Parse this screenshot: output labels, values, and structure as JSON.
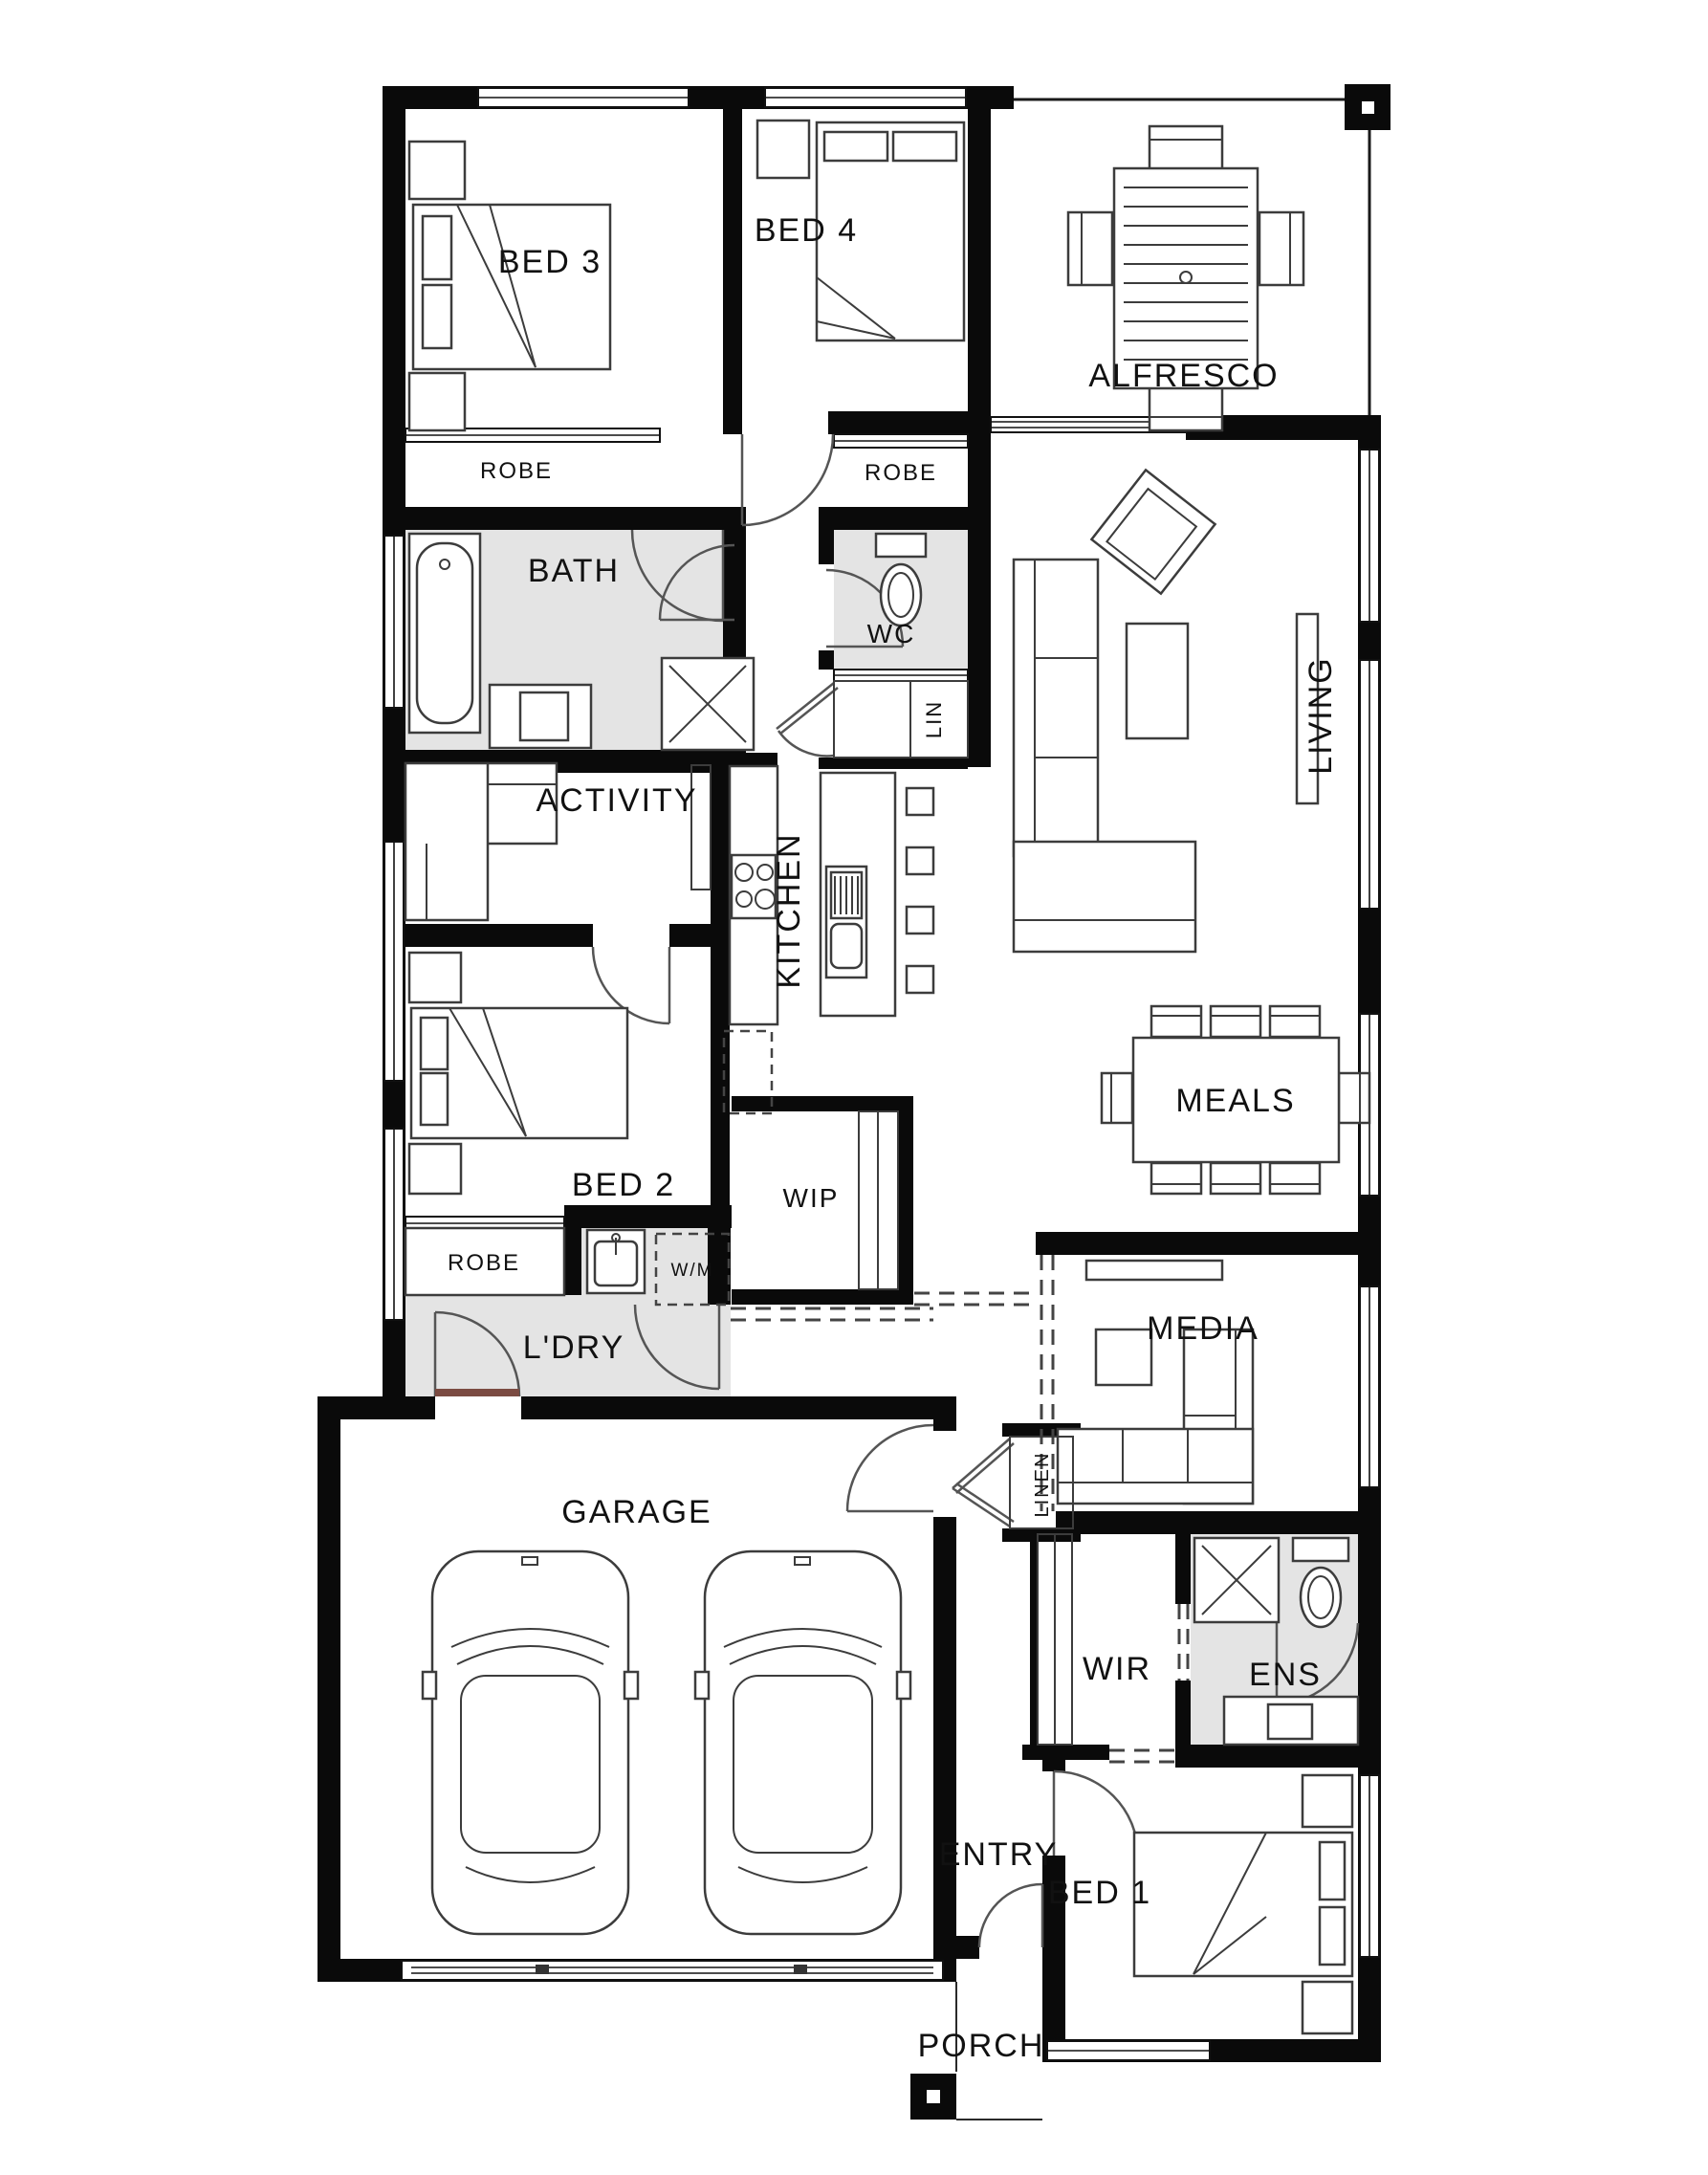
{
  "title": "Single storey home floor plan",
  "colors": {
    "background": "#ffffff",
    "walls": "#0a0a0a",
    "wet_area_fill": "#e4e4e4",
    "furniture_line": "#3c3c3c",
    "threshold": "#7b4b42"
  },
  "labels": {
    "bed3": "BED 3",
    "bed4": "BED 4",
    "alfresco": "ALFRESCO",
    "robe_bed3": "ROBE",
    "robe_bed4": "ROBE",
    "bath": "BATH",
    "wc": "WC",
    "lin": "LIN",
    "living": "LIVING",
    "activity": "ACTIVITY",
    "kitchen": "KITCHEN",
    "meals": "MEALS",
    "bed2": "BED 2",
    "wip": "WIP",
    "robe_bed2": "ROBE",
    "wm": "W/M",
    "ldry": "L'DRY",
    "media": "MEDIA",
    "garage": "GARAGE",
    "linen": "LINEN",
    "wir": "WIR",
    "ens": "ENS",
    "entry": "ENTRY",
    "bed1": "BED 1",
    "porch": "PORCH"
  }
}
